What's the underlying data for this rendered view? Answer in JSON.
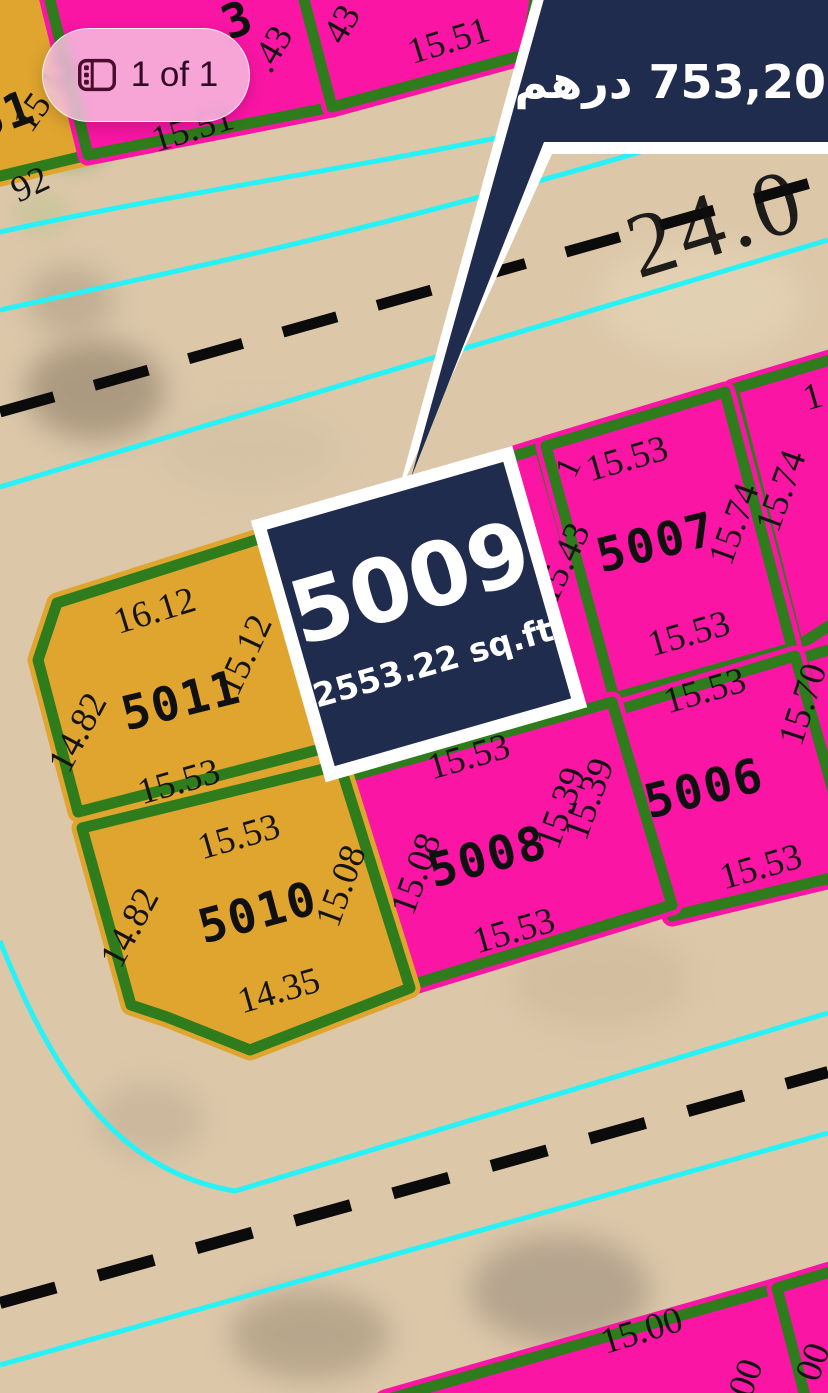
{
  "viewer": {
    "pagination_badge": {
      "label": "1 of 1",
      "icon": "page-counter-icon"
    },
    "price_banner": {
      "text": "753,200 درهم",
      "amount": "753,200",
      "currency_ar": "درهم"
    },
    "plot_callout": {
      "number": "5009",
      "area": "2553.22 sq.ft"
    }
  },
  "map": {
    "road_labels": {
      "top_road": "24.0"
    },
    "plots": {
      "p5011": {
        "number": "5011",
        "top": "16.12",
        "right": "15.12",
        "left": "14.82",
        "bottom": "15.53"
      },
      "p5010": {
        "number": "5010",
        "top": "15.53",
        "right": "15.08",
        "left": "14.82",
        "bottom": "14.35"
      },
      "p5008": {
        "number": "5008",
        "top": "15.53",
        "right": "15.39",
        "left": "15.08",
        "bottom": "15.53"
      },
      "p5007": {
        "number": "5007",
        "top": "15.53",
        "right": "15.74",
        "left": "15.43",
        "bottom": "15.53"
      },
      "p5006": {
        "number": "5006",
        "top": "15.53",
        "right": "15.70",
        "left": "15.39",
        "bottom": "15.53"
      },
      "p_right_top": {
        "left": "15.74",
        "top_partial": "1"
      },
      "p_nw_yellow": {
        "number_partial": "51",
        "right": "15.12",
        "bottom_partial": "92"
      },
      "p_north_pink_a": {
        "number_partial": "3",
        "right_partial": ".43",
        "bottom": "15.51"
      },
      "p_north_pink_b": {
        "left_partial": "43",
        "bottom": "15.51"
      },
      "p_south_a": {
        "top": "15.00",
        "right_partial": "00"
      },
      "p_south_b": {
        "left_partial": "00"
      }
    },
    "colors": {
      "sand": "#dcc7a9",
      "plot_pink": "#fa15a4",
      "plot_yellow": "#e0a52e",
      "plot_border_green": "#2e7c1b",
      "road_cyan": "#27f2f7",
      "navy": "#1f2c4e",
      "badge_pink": "#f6c8e3"
    }
  }
}
